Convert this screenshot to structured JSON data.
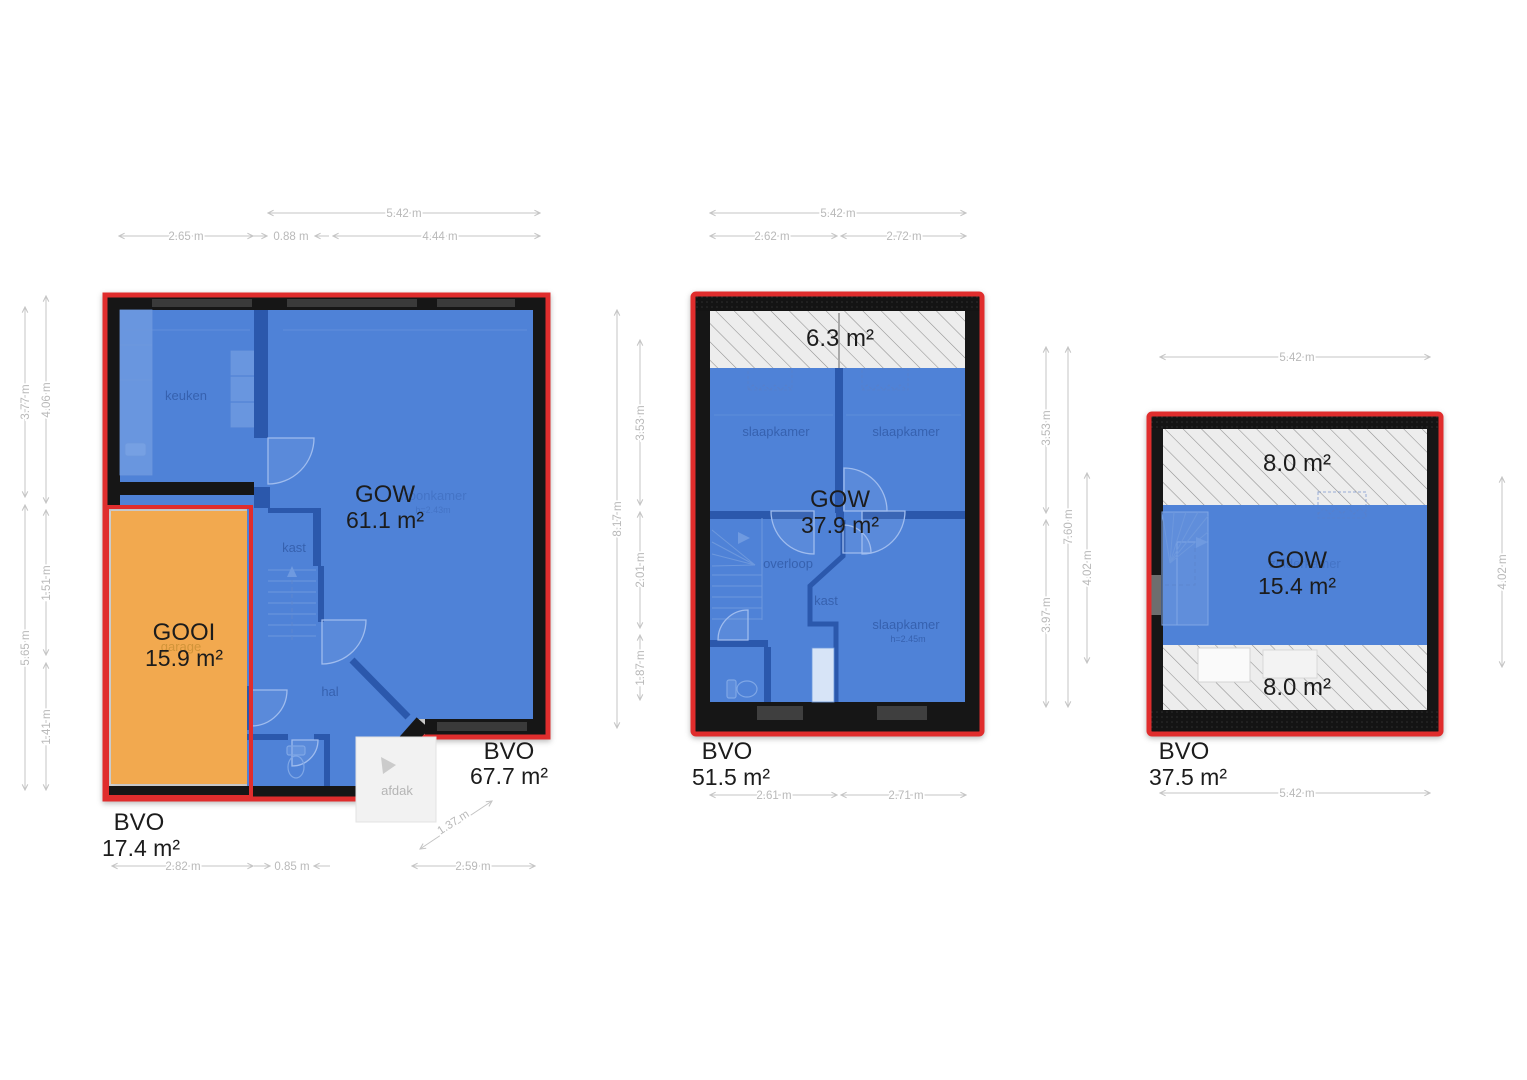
{
  "colors": {
    "area_blue": "#4f82d7",
    "area_orange": "#f2a94f",
    "outline_red": "#e02d2d",
    "wall_black": "#161616",
    "hatch_bg": "#ededed",
    "hatch_line": "#8f8f8f",
    "dim_gray": "#b9b9b9",
    "label_black": "#1c1c1c",
    "room_label_blue": "#2d55a0"
  },
  "floor1": {
    "gow": {
      "label": "GOW",
      "value": "61.1 m²"
    },
    "gooi": {
      "label": "GOOI",
      "value": "15.9 m²"
    },
    "bvo_garage": {
      "label": "BVO",
      "value": "17.4 m²"
    },
    "bvo_main": {
      "label": "BVO",
      "value": "67.7 m²"
    },
    "rooms": {
      "keuken": "keuken",
      "kast": "kast",
      "hal": "hal",
      "woonkamer": "woonkamer",
      "woonkamer_height": "h=2.43m",
      "garage": "garage",
      "afdak": "afdak"
    },
    "dims": {
      "top": [
        "5.42 m",
        "2.65 m",
        "0.88 m",
        "4.44 m"
      ],
      "left": [
        "3.77 m",
        "5.65 m",
        "4.06 m",
        "1.51 m",
        "1.41 m"
      ],
      "right": [
        "8.17 m",
        "3.53 m",
        "2.01 m",
        "1.87 m"
      ],
      "bottom": [
        "2.82 m",
        "0.85 m",
        "2.59 m"
      ],
      "diagonal": "1.37 m"
    }
  },
  "floor2": {
    "attic": {
      "value": "6.3 m²"
    },
    "gow": {
      "label": "GOW",
      "value": "37.9 m²"
    },
    "bvo": {
      "label": "BVO",
      "value": "51.5 m²"
    },
    "rooms": {
      "slaapkamer_left": "slaapkamer",
      "slaapkamer_right": "slaapkamer",
      "slaapkamer_bottom": "slaapkamer",
      "slaapkamer_bottom_height": "h=2.45m",
      "overloop": "overloop",
      "kast": "kast"
    },
    "dims": {
      "top": [
        "5.42 m",
        "2.62 m",
        "2.72 m"
      ],
      "right": [
        "3.53 m",
        "3.97 m",
        "7.60 m",
        "4.02 m"
      ],
      "bottom": [
        "2.61 m",
        "2.71 m"
      ]
    }
  },
  "floor3": {
    "attic_top": {
      "value": "8.0 m²"
    },
    "attic_bottom": {
      "value": "8.0 m²"
    },
    "gow": {
      "label": "GOW",
      "value": "15.4 m²"
    },
    "bvo": {
      "label": "BVO",
      "value": "37.5 m²"
    },
    "rooms": {
      "zolderkamer": "zolderkamer"
    },
    "dims": {
      "top": [
        "5.42 m"
      ],
      "right": [
        "4.02 m"
      ],
      "bottom": [
        "5.42 m"
      ]
    }
  }
}
